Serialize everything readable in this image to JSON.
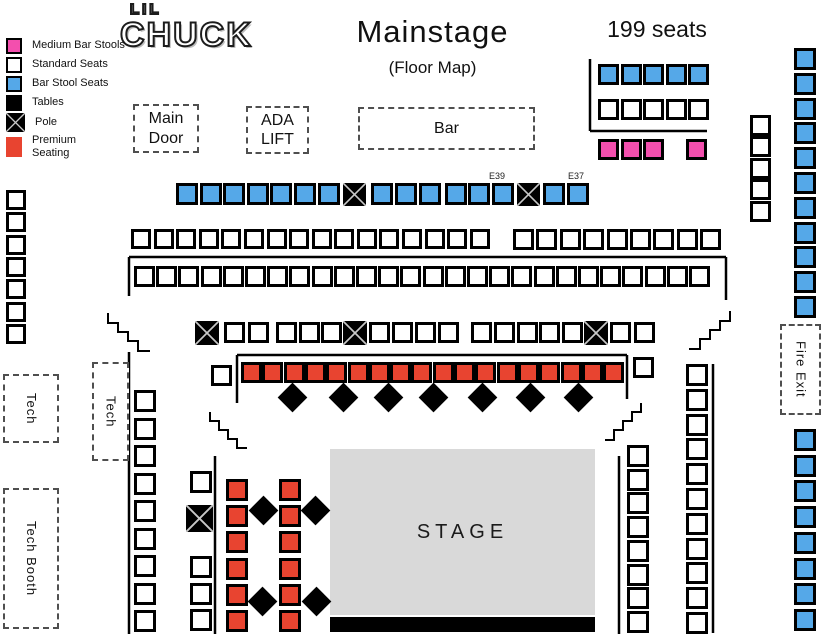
{
  "logo": {
    "line1": "LIL",
    "line2": "CHUCK"
  },
  "header": {
    "title": "Mainstage",
    "subtitle": "(Floor Map)",
    "seat_count": "199 seats"
  },
  "stage": {
    "label": "STAGE"
  },
  "colors": {
    "blue": "#55a8e8",
    "pink": "#f34fae",
    "red": "#e84430",
    "stage": "#d9d9d9"
  },
  "legend": {
    "items": [
      {
        "type": "pink",
        "label": "Medium Bar Stools"
      },
      {
        "type": "white",
        "label": "Standard Seats"
      },
      {
        "type": "blue",
        "label": "Bar Stool Seats"
      },
      {
        "type": "table",
        "label": "Tables"
      },
      {
        "type": "pole",
        "label": "Pole"
      },
      {
        "type": "red",
        "label": "Premium\nSeating"
      }
    ]
  },
  "boxes": [
    {
      "name": "main-door-box",
      "label": "Main Door",
      "x": 133,
      "y": 104,
      "w": 66,
      "h": 49,
      "vertical": false
    },
    {
      "name": "ada-lift-box",
      "label": "ADA LIFT",
      "x": 246,
      "y": 106,
      "w": 63,
      "h": 48,
      "vertical": false
    },
    {
      "name": "bar-box",
      "label": "Bar",
      "x": 358,
      "y": 107,
      "w": 177,
      "h": 43,
      "vertical": false
    },
    {
      "name": "fire-exit-box",
      "label": "Fire Exit",
      "x": 780,
      "y": 324,
      "w": 41,
      "h": 91,
      "vertical": true
    },
    {
      "name": "tech-box-left",
      "label": "Tech",
      "x": 3,
      "y": 374,
      "w": 56,
      "h": 69,
      "vertical": true
    },
    {
      "name": "tech-box-mid",
      "label": "Tech",
      "x": 92,
      "y": 362,
      "w": 37,
      "h": 99,
      "vertical": true
    },
    {
      "name": "tech-booth-box",
      "label": "Tech Booth",
      "x": 3,
      "y": 488,
      "w": 56,
      "h": 141,
      "vertical": true
    }
  ],
  "map": {
    "groups": [
      {
        "name": "tr-blue-row",
        "type": "blue",
        "dir": "row",
        "count": 5,
        "x": 598,
        "y": 64,
        "pitch": 22.6,
        "size": 21
      },
      {
        "name": "tr-white-row",
        "type": "white",
        "dir": "row",
        "count": 5,
        "x": 598,
        "y": 99,
        "pitch": 22.6,
        "size": 21
      },
      {
        "name": "tr-pink-row",
        "type": "pink",
        "dir": "row",
        "count": 3,
        "x": 598,
        "y": 139,
        "pitch": 22.6,
        "size": 21
      },
      {
        "name": "tr-pink-single",
        "type": "pink",
        "dir": "row",
        "count": 1,
        "x": 686,
        "y": 139,
        "pitch": 0,
        "size": 21
      },
      {
        "name": "right-white-col",
        "type": "white",
        "dir": "col",
        "count": 5,
        "x": 750,
        "y": 115,
        "pitch": 21.4,
        "size": 21
      },
      {
        "name": "right-blue-col-top",
        "type": "blue",
        "dir": "col",
        "count": 11,
        "x": 794,
        "y": 48,
        "pitch": 24.8,
        "size": 22
      },
      {
        "name": "right-blue-col-bottom",
        "type": "blue",
        "dir": "col",
        "count": 8,
        "x": 794,
        "y": 429,
        "pitch": 25.7,
        "size": 22
      },
      {
        "name": "left-white-col",
        "type": "white",
        "dir": "col",
        "count": 7,
        "x": 6,
        "y": 190,
        "pitch": 22.3,
        "size": 20
      },
      {
        "name": "row1-blue-a",
        "type": "blue",
        "dir": "row",
        "count": 7,
        "x": 176,
        "y": 183,
        "pitch": 23.6,
        "size": 22
      },
      {
        "name": "row1-pole-a",
        "type": "pole",
        "dir": "row",
        "count": 1,
        "x": 343,
        "y": 183,
        "pitch": 0,
        "size": 23
      },
      {
        "name": "row1-blue-b",
        "type": "blue",
        "dir": "row",
        "count": 3,
        "x": 371,
        "y": 183,
        "pitch": 24,
        "size": 22
      },
      {
        "name": "row1-blue-c",
        "type": "blue",
        "dir": "row",
        "count": 3,
        "x": 445,
        "y": 183,
        "pitch": 23.3,
        "size": 22
      },
      {
        "name": "row1-pole-b",
        "type": "pole",
        "dir": "row",
        "count": 1,
        "x": 517,
        "y": 183,
        "pitch": 0,
        "size": 23
      },
      {
        "name": "row1-blue-d",
        "type": "blue",
        "dir": "row",
        "count": 2,
        "x": 543,
        "y": 183,
        "pitch": 23.5,
        "size": 22
      },
      {
        "name": "row2-white-a",
        "type": "white",
        "dir": "row",
        "count": 7,
        "x": 131,
        "y": 229,
        "pitch": 22.6,
        "size": 20
      },
      {
        "name": "row2-white-b",
        "type": "white",
        "dir": "row",
        "count": 9,
        "x": 289,
        "y": 229,
        "pitch": 22.6,
        "size": 20
      },
      {
        "name": "row2-white-c",
        "type": "white",
        "dir": "row",
        "count": 9,
        "x": 513,
        "y": 229,
        "pitch": 23.4,
        "size": 21
      },
      {
        "name": "row3-white",
        "type": "white",
        "dir": "row",
        "count": 26,
        "x": 134,
        "y": 266,
        "pitch": 22.2,
        "size": 21
      },
      {
        "name": "row4-pole-a",
        "type": "pole",
        "dir": "row",
        "count": 1,
        "x": 195,
        "y": 321,
        "pitch": 0,
        "size": 24
      },
      {
        "name": "row4-white-a",
        "type": "white",
        "dir": "row",
        "count": 2,
        "x": 224,
        "y": 322,
        "pitch": 24,
        "size": 21
      },
      {
        "name": "row4-white-b",
        "type": "white",
        "dir": "row",
        "count": 3,
        "x": 276,
        "y": 322,
        "pitch": 22.5,
        "size": 21
      },
      {
        "name": "row4-pole-b",
        "type": "pole",
        "dir": "row",
        "count": 1,
        "x": 343,
        "y": 321,
        "pitch": 0,
        "size": 24
      },
      {
        "name": "row4-white-c",
        "type": "white",
        "dir": "row",
        "count": 4,
        "x": 369,
        "y": 322,
        "pitch": 23,
        "size": 21
      },
      {
        "name": "row4-white-d",
        "type": "white",
        "dir": "row",
        "count": 5,
        "x": 471,
        "y": 322,
        "pitch": 22.8,
        "size": 21
      },
      {
        "name": "row4-pole-c",
        "type": "pole",
        "dir": "row",
        "count": 1,
        "x": 584,
        "y": 321,
        "pitch": 0,
        "size": 24
      },
      {
        "name": "row4-white-e",
        "type": "white",
        "dir": "row",
        "count": 2,
        "x": 610,
        "y": 322,
        "pitch": 24,
        "size": 21
      },
      {
        "name": "premium-row-left-white",
        "type": "white",
        "dir": "row",
        "count": 1,
        "x": 211,
        "y": 365,
        "pitch": 0,
        "size": 21
      },
      {
        "name": "premium-row",
        "type": "red",
        "dir": "row",
        "count": 18,
        "x": 241,
        "y": 362,
        "pitch": 21.3,
        "size": 21
      },
      {
        "name": "premium-row-right-white",
        "type": "white",
        "dir": "row",
        "count": 1,
        "x": 633,
        "y": 357,
        "pitch": 0,
        "size": 21
      },
      {
        "name": "left-bottom-white-col",
        "type": "white",
        "dir": "col",
        "count": 9,
        "x": 134,
        "y": 390,
        "pitch": 27.5,
        "size": 22
      },
      {
        "name": "mid-col-white-top",
        "type": "white",
        "dir": "col",
        "count": 1,
        "x": 190,
        "y": 471,
        "pitch": 0,
        "size": 22
      },
      {
        "name": "mid-col-pole",
        "type": "pole",
        "dir": "col",
        "count": 1,
        "x": 186,
        "y": 505,
        "pitch": 0,
        "size": 27
      },
      {
        "name": "mid-col-white-bottom",
        "type": "white",
        "dir": "col",
        "count": 3,
        "x": 190,
        "y": 556,
        "pitch": 26.5,
        "size": 22
      },
      {
        "name": "premium-col-a",
        "type": "red",
        "dir": "col",
        "count": 6,
        "x": 226,
        "y": 479,
        "pitch": 26.2,
        "size": 22
      },
      {
        "name": "premium-col-b",
        "type": "red",
        "dir": "col",
        "count": 6,
        "x": 279,
        "y": 479,
        "pitch": 26.2,
        "size": 22
      },
      {
        "name": "stage-right-col-inner",
        "type": "white",
        "dir": "col",
        "count": 8,
        "x": 627,
        "y": 445,
        "pitch": 23.7,
        "size": 22
      },
      {
        "name": "stage-right-col-outer",
        "type": "white",
        "dir": "col",
        "count": 11,
        "x": 686,
        "y": 364,
        "pitch": 24.8,
        "size": 22
      }
    ],
    "tables": [
      [
        292,
        397
      ],
      [
        343,
        397
      ],
      [
        388,
        397
      ],
      [
        433,
        397
      ],
      [
        482,
        397
      ],
      [
        530,
        397
      ],
      [
        578,
        397
      ],
      [
        263,
        510
      ],
      [
        315,
        510
      ],
      [
        262,
        601
      ],
      [
        316,
        601
      ]
    ],
    "table_size": 21,
    "seat_labels": [
      {
        "text": "E39",
        "x": 497,
        "y": 171
      },
      {
        "text": "E37",
        "x": 576,
        "y": 171
      }
    ],
    "lines": [
      [
        590,
        59,
        590,
        131
      ],
      [
        590,
        131,
        707,
        131
      ],
      [
        129,
        257,
        129,
        296
      ],
      [
        129,
        257,
        726,
        257
      ],
      [
        726,
        257,
        726,
        300
      ],
      [
        237,
        355,
        237,
        403
      ],
      [
        237,
        355,
        627,
        355
      ],
      [
        627,
        355,
        627,
        399
      ],
      [
        129,
        352,
        129,
        634
      ],
      [
        215,
        456,
        215,
        634
      ],
      [
        619,
        456,
        619,
        634
      ],
      [
        713,
        364,
        713,
        633
      ]
    ],
    "stairs": [
      "108,313 108,323 118,323 118,332 128,332 128,341 138,341 138,351 150,351",
      "730,311 730,321 720,321 720,330 710,330 710,339 700,339 700,349 689,349",
      "210,412 210,421 219,421 219,430 228,430 228,439 237,439 237,448 247,448",
      "641,403 641,412 632,412 632,421 623,421 623,430 614,430 614,440 605,440"
    ]
  }
}
